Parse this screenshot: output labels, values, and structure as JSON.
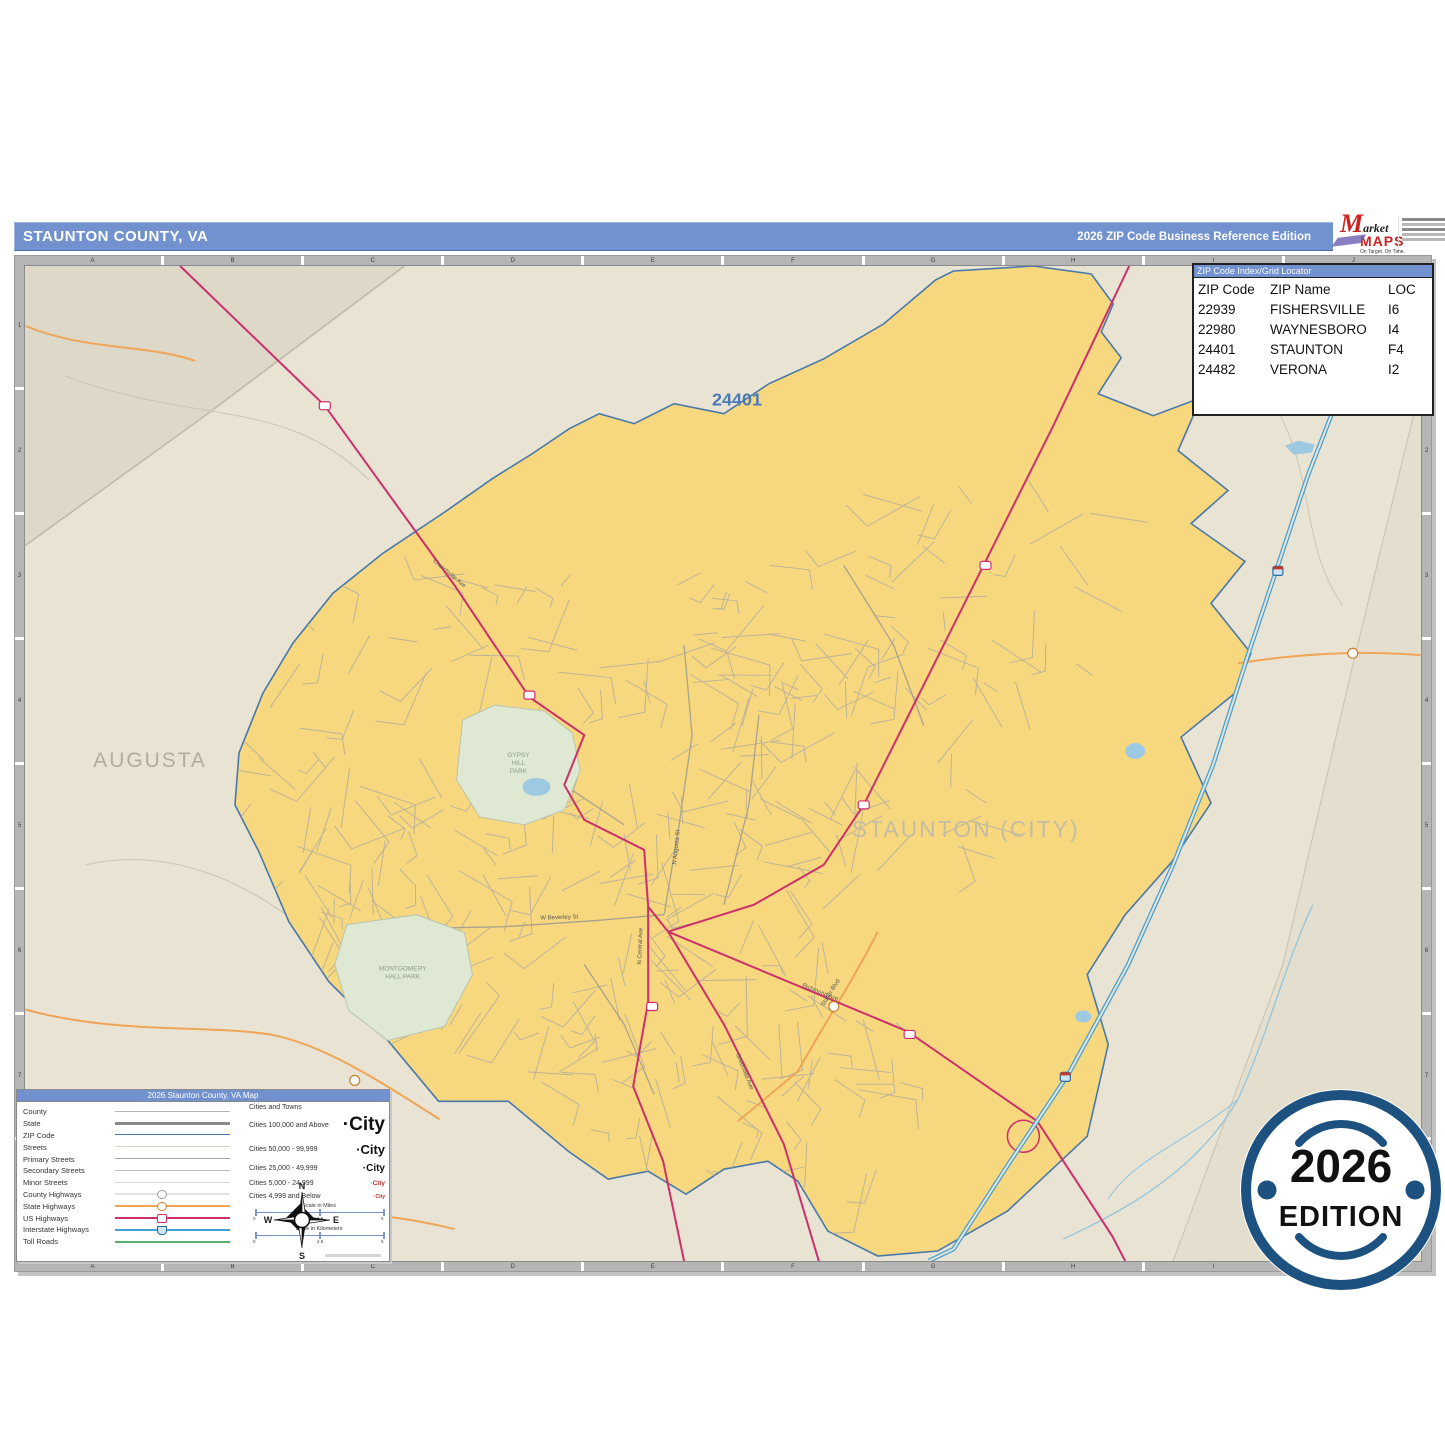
{
  "header": {
    "title": "STAUNTON COUNTY, VA",
    "edition": "2026 ZIP Code Business Reference Edition",
    "logo": {
      "m": "M",
      "market": "arket",
      "maps": "MAPS",
      "tagline": "On Target. On Time.",
      "subtitle": "America's Leading Source of Business Maps"
    }
  },
  "zip_table": {
    "title": "ZIP Code Index/Grid Locator",
    "columns": [
      "ZIP Code",
      "ZIP Name",
      "LOC"
    ],
    "rows": [
      {
        "code": "22939",
        "name": "FISHERSVILLE",
        "loc": "I6"
      },
      {
        "code": "22980",
        "name": "WAYNESBORO",
        "loc": "I4"
      },
      {
        "code": "24401",
        "name": "STAUNTON",
        "loc": "F4"
      },
      {
        "code": "24482",
        "name": "VERONA",
        "loc": "I2"
      }
    ]
  },
  "grid": {
    "cols": [
      "A",
      "B",
      "C",
      "D",
      "E",
      "F",
      "G",
      "H",
      "I",
      "J"
    ],
    "rows": [
      "1",
      "2",
      "3",
      "4",
      "5",
      "6",
      "7",
      "8"
    ]
  },
  "map": {
    "zip_label_main": "24401",
    "zip_label_ne": "24482",
    "county_label": "AUGUSTA",
    "city_label": "STAUNTON (CITY)",
    "park_labels": [
      "GYPSY\nHILL\nPARK",
      "MONTGOMERY\nHALL PARK"
    ],
    "street_labels": [
      "Churchville Ave",
      "Richmond Ave",
      "Greenville Ave",
      "Statler Blvd",
      "N Central Ave",
      "W Beverley St",
      "N Augusta St"
    ]
  },
  "legend": {
    "title": "2026 Staunton County, VA Map",
    "line_items": [
      {
        "label": "County",
        "style": "county"
      },
      {
        "label": "State",
        "style": "state"
      },
      {
        "label": "ZIP Code",
        "style": "zip"
      },
      {
        "label": "Streets",
        "style": "streets"
      },
      {
        "label": "Primary Streets",
        "style": "primary"
      },
      {
        "label": "Secondary Streets",
        "style": "secondary"
      },
      {
        "label": "Minor Streets",
        "style": "minor"
      },
      {
        "label": "County Highways",
        "style": "countyhwy"
      },
      {
        "label": "State Highways",
        "style": "statehwy"
      },
      {
        "label": "US Highways",
        "style": "ushwy"
      },
      {
        "label": "Interstate Highways",
        "style": "interstate"
      },
      {
        "label": "Toll Roads",
        "style": "toll"
      }
    ],
    "cities_header": "Cities and Towns",
    "city_sample": "·City",
    "city_classes": [
      "Cities 100,000 and Above",
      "Cities 50,000 - 99,999",
      "Cities 25,000 - 49,999",
      "Cities 5,000 - 24,999",
      "Cities 4,999 and Below"
    ],
    "scales": [
      {
        "label": "Scale in Miles",
        "ticks": [
          "0",
          "2.5",
          "5"
        ]
      },
      {
        "label": "Scale in Kilometers",
        "ticks": [
          "0",
          "2.5",
          "5"
        ]
      }
    ]
  },
  "compass": {
    "n": "N",
    "e": "E",
    "s": "S",
    "w": "W"
  },
  "badge": {
    "year": "2026",
    "edition": "EDITION"
  },
  "colors": {
    "bar": "#7191cf",
    "beige": "#e8e3d3",
    "beige_out": "#ddd8c8",
    "zip_fill": "#f8d87e",
    "zipline": "#4878aa",
    "pink": "#cc2f6b",
    "orange": "#f0a456",
    "blue": "#44a0d6",
    "green": "#55b06c",
    "creek": "#8fc3de",
    "park": "#dfe8d3",
    "pond": "#9ec9e2",
    "street": "#bab29b",
    "ziplabel": "#4a79b8",
    "graylabel": "#b3ae9f",
    "navy": "#1c5180"
  }
}
